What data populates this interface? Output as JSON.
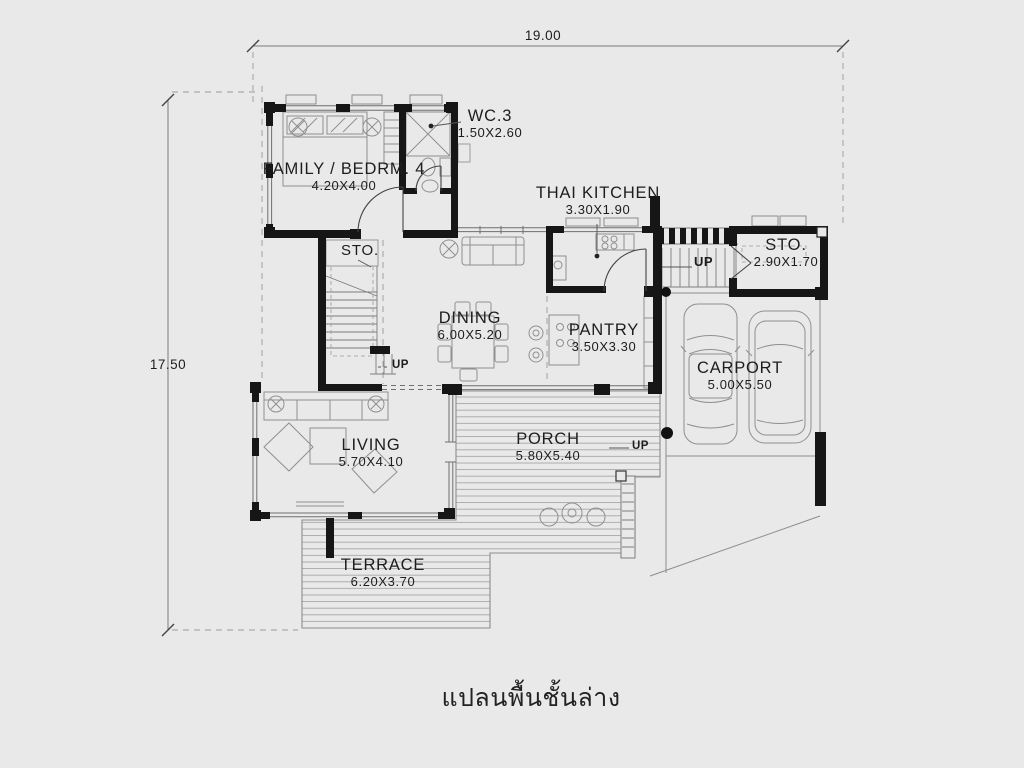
{
  "title": "แปลนพื้นชั้นล่าง",
  "dimensions": {
    "overall_width": "19.00",
    "overall_depth": "17.50"
  },
  "rooms": {
    "family_bedrm": {
      "name": "FAMILY / BEDRM. 4",
      "size": "4.20X4.00"
    },
    "wc3": {
      "name": "WC.3",
      "size": "1.50X2.60"
    },
    "sto_stairs": {
      "name": "STO."
    },
    "thai_kitchen": {
      "name": "THAI  KITCHEN",
      "size": "3.30X1.90"
    },
    "sto_carport": {
      "name": "STO.",
      "size": "2.90X1.70"
    },
    "dining": {
      "name": "DINING",
      "size": "6.00X5.20"
    },
    "pantry": {
      "name": "PANTRY",
      "size": "3.50X3.30"
    },
    "carport": {
      "name": "CARPORT",
      "size": "5.00X5.50"
    },
    "living": {
      "name": "LIVING",
      "size": "5.70X4.10"
    },
    "porch": {
      "name": "PORCH",
      "size": "5.80X5.40"
    },
    "terrace": {
      "name": "TERRACE",
      "size": "6.20X3.70"
    }
  },
  "stairs": {
    "up_main": "UP",
    "up_side": "UP",
    "up_porch": "UP"
  },
  "colors": {
    "background": "#e9e9e9",
    "walls": "#161616",
    "furniture": "#909090",
    "ink": "#1d1d1d"
  }
}
